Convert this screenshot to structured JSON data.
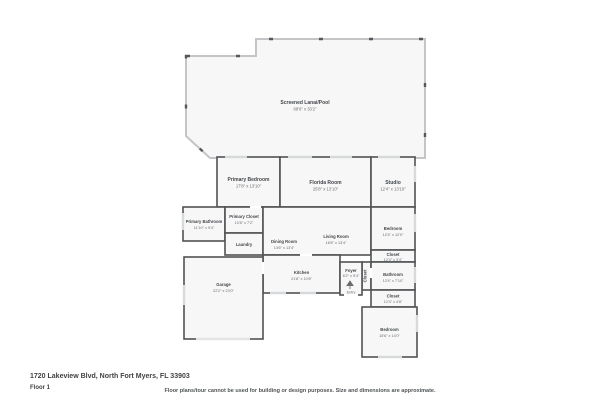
{
  "page": {
    "address": "1720 Lakeview Blvd, North Fort Myers, FL 33903",
    "floor_label": "Floor 1",
    "disclaimer": "Floor plans/tour cannot be used for building or design purposes. Size and dimensions are approximate."
  },
  "colors": {
    "wall": "#505254",
    "room_fill": "#f7f7f8",
    "screen_wall": "#c3c5c7",
    "window_marker": "#d7d9da",
    "label_text": "#45474a"
  },
  "rooms": {
    "lanai": {
      "name": "Screened Lanai/Pool",
      "dims": "68'6\" x 33'2\""
    },
    "primary_bedroom": {
      "name": "Primary Bedroom",
      "dims": "17'8\" x 13'10\""
    },
    "florida_room": {
      "name": "Florida Room",
      "dims": "25'8\" x 13'10\""
    },
    "studio": {
      "name": "Studio",
      "dims": "12'4\" x 13'10\""
    },
    "primary_bathroom": {
      "name": "Primary Bathroom",
      "dims": "11'10\" x 9'4\""
    },
    "primary_closet": {
      "name": "Primary Closet",
      "dims": "10'8\" x 7'2\""
    },
    "laundry": {
      "name": "Laundry",
      "dims": ""
    },
    "dining_room": {
      "name": "Dining Room",
      "dims": "13'6\" x 13'4\""
    },
    "living_room": {
      "name": "Living Room",
      "dims": "16'8\" x 13'4\""
    },
    "bedroom_1": {
      "name": "Bedroom",
      "dims": "12'4\" x 12'0\""
    },
    "closet_a": {
      "name": "Closet",
      "dims": "12'4\" x 3'4\""
    },
    "closet_strip": {
      "name": "Closet",
      "dims": ""
    },
    "bathroom": {
      "name": "Bathroom",
      "dims": "12'4\" x 7'10\""
    },
    "closet_b": {
      "name": "Closet",
      "dims": "12'4\" x 4'8\""
    },
    "bedroom_2": {
      "name": "Bedroom",
      "dims": "15'6\" x 14'0\""
    },
    "kitchen": {
      "name": "Kitchen",
      "dims": "21'8\" x 10'8\""
    },
    "foyer": {
      "name": "Foyer",
      "dims": "6'2\" x 9'4\""
    },
    "entry": {
      "name": "Entry",
      "dims": ""
    },
    "garage": {
      "name": "Garage",
      "dims": "22'2\" x 23'0\""
    }
  }
}
